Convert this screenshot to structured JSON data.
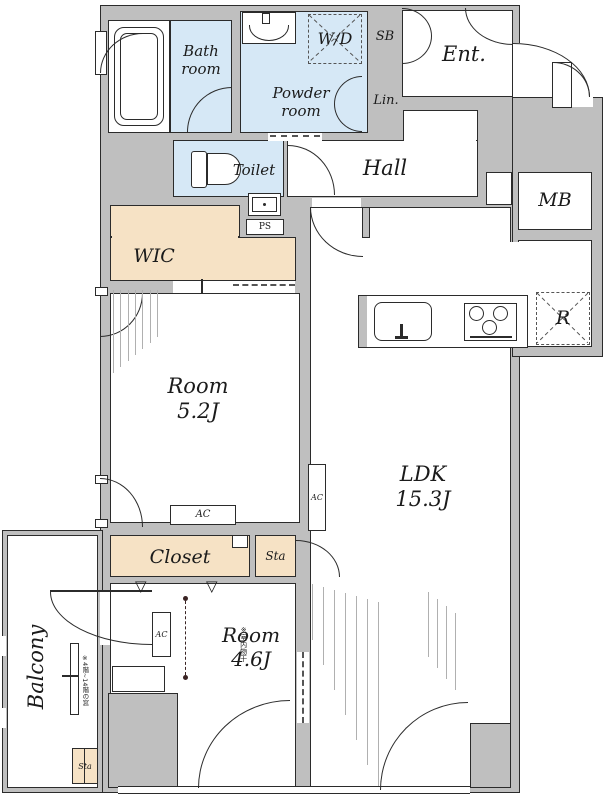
{
  "plan_title": "Apartment floor plan",
  "colors": {
    "wall": "#bfbfbf",
    "wet_area": "#d6e8f6",
    "storage": "#f6e2c5",
    "outline": "#2b2b2b",
    "floor": "#ffffff"
  },
  "labels": {
    "bath": "Bath\nroom",
    "powder": "Powder\nroom",
    "toilet": "Toilet",
    "wd": "W/D",
    "sb": "SB",
    "lin": "Lin.",
    "ent": "Ent.",
    "hall": "Hall",
    "mb": "MB",
    "wic": "WIC",
    "ps": "PS",
    "room1": "Room\n5.2J",
    "ldk": "LDK\n15.3J",
    "room2": "Room\n4.6J",
    "closet": "Closet",
    "sta": "Sta",
    "sta_balcony": "Sta",
    "balcony": "Balcony",
    "fridge": "R",
    "ac": "AC",
    "note_window": "※4階~14階の窓",
    "note_drying": "※室内物干"
  }
}
